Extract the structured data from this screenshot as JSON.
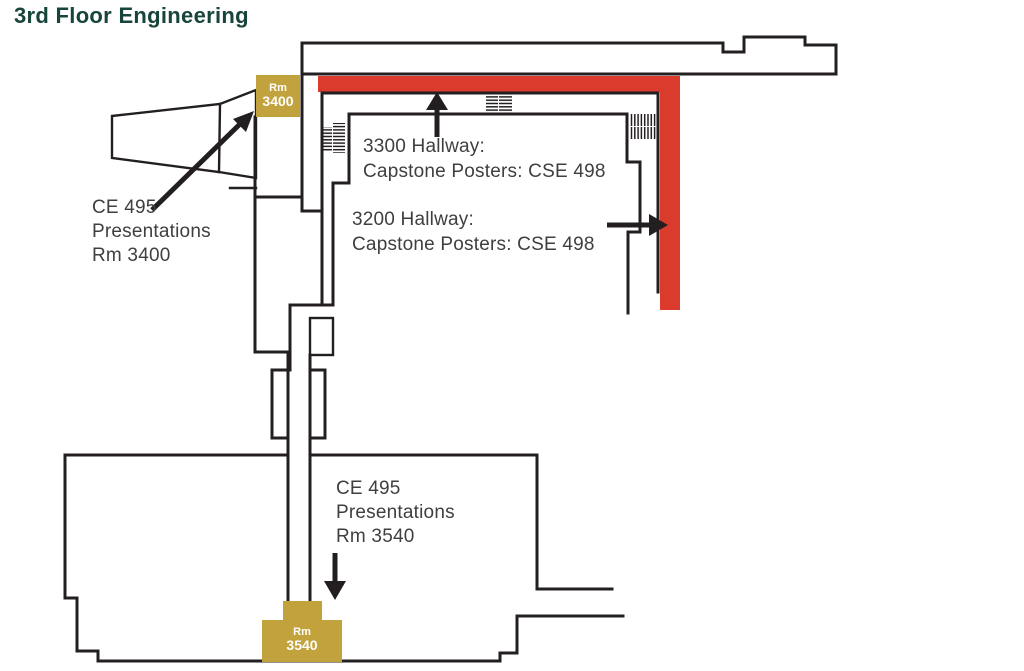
{
  "title": "3rd Floor Engineering",
  "colors": {
    "title_green": "#18453B",
    "wall_black": "#231F20",
    "hallway_red": "#DA3B2D",
    "room_gold": "#C2A23C",
    "label_gray": "#3F3F41",
    "room_text_white": "#FFFFFF"
  },
  "rooms": {
    "rm3400": {
      "name": "Rm",
      "number": "3400"
    },
    "rm3540": {
      "name": "Rm",
      "number": "3540"
    }
  },
  "annotations": {
    "ce495_rm3400": {
      "lines": [
        "CE 495",
        "Presentations",
        "Rm 3400"
      ]
    },
    "hallway_3300": {
      "lines": [
        "3300 Hallway:",
        "Capstone Posters: CSE 498"
      ]
    },
    "hallway_3200": {
      "lines": [
        "3200 Hallway:",
        "Capstone Posters: CSE 498"
      ]
    },
    "ce495_rm3540": {
      "lines": [
        "CE 495",
        "Presentations",
        "Rm 3540"
      ]
    }
  },
  "icons": {
    "stairs_west": "stairs-hatch",
    "stairs_north": "stairs-hatch",
    "stairs_east": "stairs-hatch",
    "arrow_up": "arrow-up",
    "arrow_diagonal": "arrow-up-right",
    "arrow_right": "arrow-right",
    "arrow_down": "arrow-down"
  }
}
